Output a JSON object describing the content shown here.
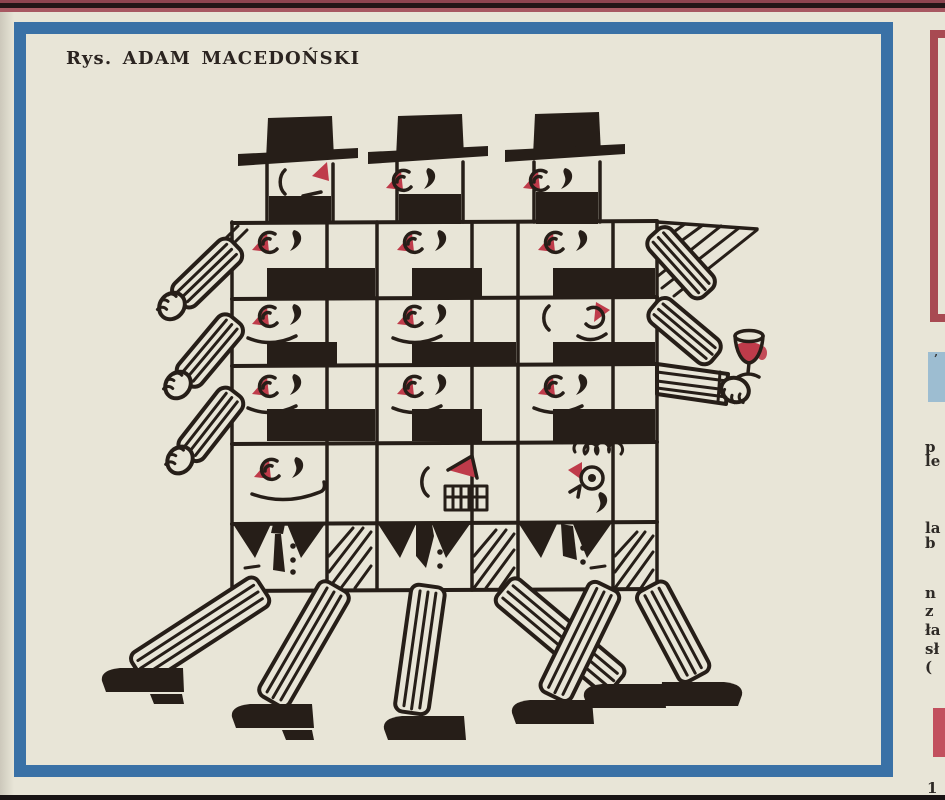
{
  "page": {
    "paper_color": "#e8e5d7",
    "top_edge_bars": {
      "maroon": "#8e4450",
      "black": "#231517",
      "red": "#a85862"
    },
    "bottom_bar_color": "#191414"
  },
  "panel": {
    "caption": "Rys. ADAM MACEDOŃSKI",
    "frame_color": "#3a71a6"
  },
  "illustration": {
    "ink_color": "#261e18",
    "accent_red": "#bf3b4a",
    "subject": "Checkerboard block of identical marching men in black hats; striped arms and legs protrude, one raised hand holds a glass of red wine."
  },
  "right_column": {
    "red_frame_color": "#a84a52",
    "blue_block_color": "#9dbdd1",
    "pink_block_color": "#c2505e",
    "fragments": [
      "p",
      "le",
      "la",
      "b",
      "n",
      "z",
      "ła",
      "sł",
      "(",
      "1",
      "’"
    ]
  }
}
